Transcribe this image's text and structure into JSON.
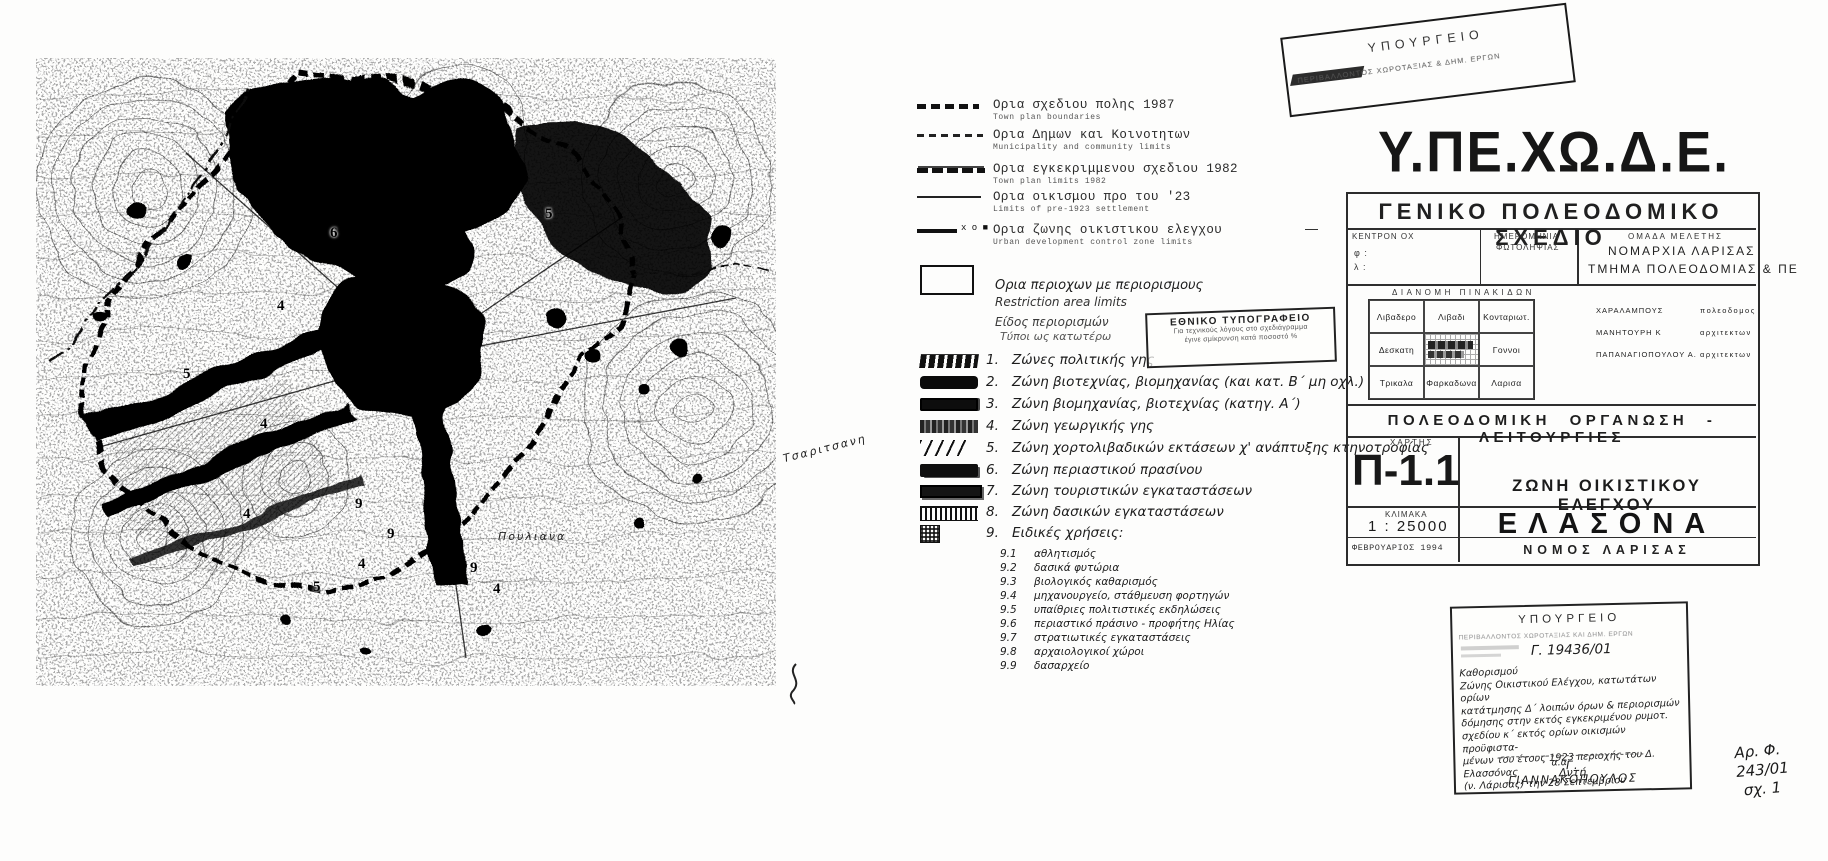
{
  "colors": {
    "ink": "#141414",
    "mid": "#444444",
    "faded": "#8a8a8a",
    "paper": "#fdfdfc"
  },
  "stamps": {
    "top_ministry": {
      "line1": "ΥΠΟΥΡΓΕΙΟ",
      "line2": "ΠΕΡΙΒΑΛΛΟΝΤΟΣ ΧΩΡΟΤΑΞΙΑΣ & ΔΗΜ. ΕΡΓΩΝ"
    },
    "national_press": {
      "title": "ΕΘΝΙΚΟ ΤΥΠΟΓΡΑΦΕΙΟ",
      "line2": "Για τεχνικούς λόγους στο σχεδιάγραμμα",
      "line3": "έγινε σμίκρυνση κατά ποσοστό %"
    },
    "approval": {
      "header": "ΥΠΟΥΡΓΕΙΟ",
      "dept": "ΠΕΡΙΒΑΛΛΟΝΤΟΣ ΧΩΡΟΤΑΞΙΑΣ ΚΑΙ ΔΗΜ. ΕΡΓΩΝ",
      "protocol": "Γ. 19436/01",
      "note_lines": [
        "Καθορισμού",
        "Ζώνης Οικιστικού Ελέγχου, κατωτάτων ορίων",
        "κατάτμησης Δ΄ λοιπών όρων & περιορισμών",
        "δόμησης στην εκτός εγκεκριμένου ρυμοτ.",
        "σχεδίου κ΄ εκτός ορίων οικισμών προϋφιστα-",
        "μένων του έτους 1923 περιοχής του Δ. Ελασσόνας",
        "(ν. Λάρισας) την 28 Σεπτεμβρίου"
      ],
      "closing": "Δντή",
      "aa": "α.α",
      "signature": "Γ. ΓΙΑΝΝΑΚΟΠΟΥΛΟΣ"
    },
    "file_ref": {
      "line1": "Αρ. Φ. 243/01",
      "line2": "σχ. 1"
    }
  },
  "legend": {
    "line_items": [
      {
        "gr": "Ορια σχεδιου πολης 1987",
        "en": "Town plan boundaries"
      },
      {
        "gr": "Ορια Δημων και Κοινοτητων",
        "en": "Municipality and community limits"
      },
      {
        "gr": "Ορια εγκεκριμμενου σχεδιου 1982",
        "en": "Town plan limits 1982"
      },
      {
        "gr": "Ορια οικισμου προ του '23",
        "en": "Limits of pre-1923 settlement"
      },
      {
        "gr": "Ορια ζωνης οικιστικου ελεγχου",
        "en": "Urban development control zone limits",
        "marks": "x o ■",
        "trail": "—"
      }
    ],
    "restriction": {
      "gr": "Ορια περιοχων με περιορισμους",
      "en": "Restriction area limits"
    },
    "restriction_note1": "Είδος περιορισμών",
    "restriction_note2": "Τύποι ως κατωτέρω",
    "zones": [
      {
        "num": "1.",
        "label": "Ζώνες πολιτικής γης"
      },
      {
        "num": "2.",
        "label": "Ζώνη βιοτεχνίας, βιομηχανίας (και κατ. Β΄ μη οχλ.)"
      },
      {
        "num": "3.",
        "label": "Ζώνη βιομηχανίας, βιοτεχνίας (κατηγ. Α΄)"
      },
      {
        "num": "4.",
        "label": "Ζώνη γεωργικής γης"
      },
      {
        "num": "5.",
        "label": "Ζώνη χορτολιβαδικών εκτάσεων χ' ανάπτυξης κτηνοτροφίας"
      },
      {
        "num": "6.",
        "label": "Ζώνη περιαστικού πρασίνου"
      },
      {
        "num": "7.",
        "label": "Ζώνη τουριστικών εγκαταστάσεων"
      },
      {
        "num": "8.",
        "label": "Ζώνη δασικών εγκαταστάσεων"
      },
      {
        "num": "9.",
        "label": "Ειδικές χρήσεις:"
      }
    ],
    "special_uses": [
      {
        "num": "9.1",
        "label": "αθλητισμός"
      },
      {
        "num": "9.2",
        "label": "δασικά φυτώρια"
      },
      {
        "num": "9.3",
        "label": "βιολογικός καθαρισμός"
      },
      {
        "num": "9.4",
        "label": "μηχανουργείο, στάθμευση φορτηγών"
      },
      {
        "num": "9.5",
        "label": "υπαίθριες πολιτιστικές εκδηλώσεις"
      },
      {
        "num": "9.6",
        "label": "περιαστικό πράσινο - προφήτης Ηλίας"
      },
      {
        "num": "9.7",
        "label": "στρατιωτικές εγκαταστάσεις"
      },
      {
        "num": "9.8",
        "label": "αρχαιολογικοί χώροι"
      },
      {
        "num": "9.9",
        "label": "δασαρχείο"
      }
    ]
  },
  "title_block": {
    "ministry": "Υ.ΠΕ.ΧΩ.Δ.Ε.",
    "plan_title": "ΓΕΝΙΚΟ  ΠΟΛΕΟΔΟΜΙΚΟ  ΣΧΕΔΙΟ",
    "kentron": "ΚΕΝΤΡΟΝ ΟΧ",
    "phi": "φ :",
    "lambda": "λ :",
    "photo_date_1": "ΗΜΕΡΟΜΗΝΙΑ",
    "photo_date_2": "ΦΩΤΟΛΗΨΙΑΣ",
    "team": "ΟΜΑΔΑ ΜΕΛΕΤΗΣ",
    "prefecture": "ΝΟΜΑΡΧΙΑ ΛΑΡΙΣΑΣ",
    "department": "ΤΜΗΜΑ ΠΟΛΕΟΔΟΜΙΑΣ & ΠΕ",
    "sheet_index_title": "ΔΙΑΝΟΜΗ ΠΙΝΑΚΙΔΩΝ",
    "sheet_grid": [
      [
        "Λιβαδερο",
        "Λιβαδι",
        "Κονταριωτ."
      ],
      [
        "Δεσκατη",
        "",
        "Γοννοι"
      ],
      [
        "Τρικαλα",
        "Φαρκαδωνα",
        "Λαρισα"
      ]
    ],
    "staff": [
      {
        "name": "ΧΑΡΑΛΑΜΠΟΥΣ",
        "role": "πολεοδομος"
      },
      {
        "name": "ΜΑΝΗΤΟΥΡΗ Κ",
        "role": "αρχιτεκτων"
      },
      {
        "name": "ΠΑΠΑΝΑΓΙΟΠΟΥΛΟΥ Α.",
        "role": "αρχιτεκτων"
      }
    ],
    "section_title": "ΠΟΛΕΟΔΟΜΙΚΗ ΟΡΓΑΝΩΣΗ - ΛΕΙΤΟΥΡΓΙΕΣ",
    "map_label": "ΧΑΡΤΗΣ",
    "map_code": "Π-1.1",
    "zone_title": "ΖΩΝΗ ΟΙΚΙΣΤΙΚΟΥ ΕΛΕΓΧΟΥ",
    "scale_label": "ΚΛΙΜΑΚΑ",
    "scale_value": "1 : 25000",
    "date": "ΦΕΒΡΟΥΑΡΙΟΣ 1994",
    "city": "ΕΛΑΣΟΝΑ",
    "region": "ΝΟΜΟΣ ΛΑΡΙΣΑΣ"
  },
  "map": {
    "labels": [
      {
        "t": "6",
        "x": 330,
        "y": 225,
        "kind": "num"
      },
      {
        "t": "5",
        "x": 545,
        "y": 206,
        "kind": "num"
      },
      {
        "t": "4",
        "x": 277,
        "y": 298,
        "kind": "num"
      },
      {
        "t": "5",
        "x": 183,
        "y": 366,
        "kind": "num"
      },
      {
        "t": "4",
        "x": 260,
        "y": 416,
        "kind": "num"
      },
      {
        "t": "4",
        "x": 243,
        "y": 506,
        "kind": "num"
      },
      {
        "t": "9",
        "x": 355,
        "y": 496,
        "kind": "num"
      },
      {
        "t": "9",
        "x": 387,
        "y": 526,
        "kind": "num"
      },
      {
        "t": "4",
        "x": 358,
        "y": 556,
        "kind": "num"
      },
      {
        "t": "5",
        "x": 313,
        "y": 579,
        "kind": "num"
      },
      {
        "t": "9",
        "x": 470,
        "y": 560,
        "kind": "num"
      },
      {
        "t": "4",
        "x": 493,
        "y": 581,
        "kind": "num"
      },
      {
        "t": "Πουλιανα",
        "x": 498,
        "y": 530,
        "kind": "place"
      },
      {
        "t": "Τσαριτσανη",
        "x": 782,
        "y": 442,
        "kind": "place",
        "rot": -14
      }
    ]
  }
}
